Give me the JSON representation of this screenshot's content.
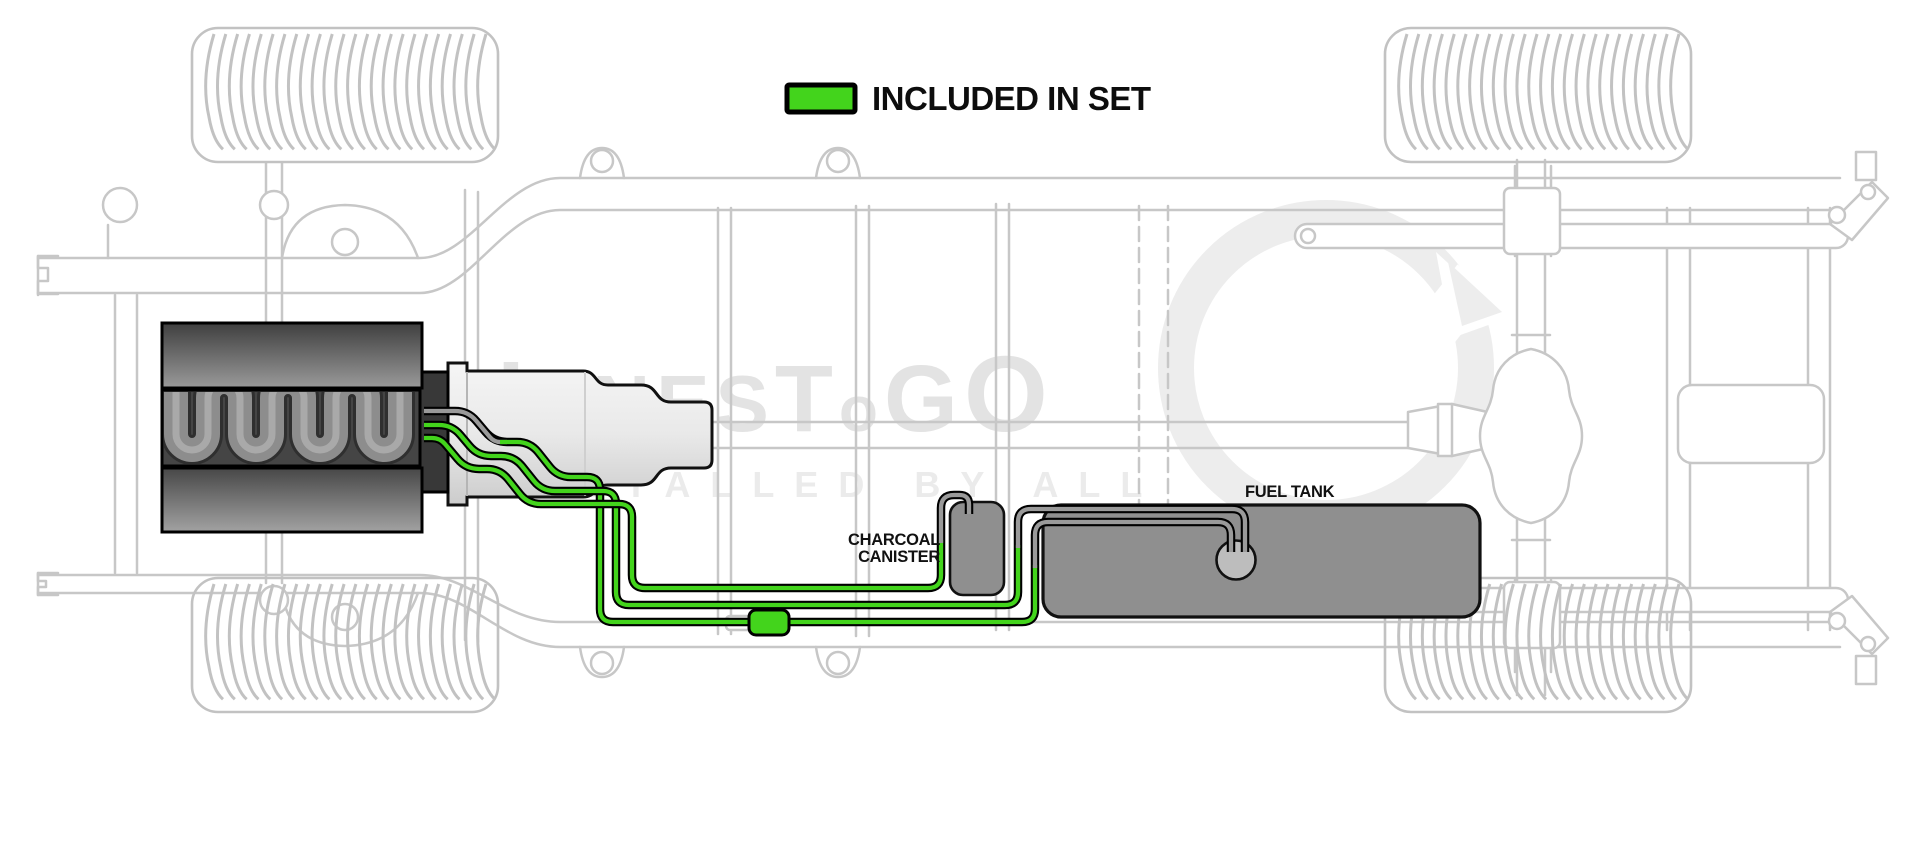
{
  "legend": {
    "label": "INCLUDED IN SET",
    "swatch_color": "#43d41c"
  },
  "labels": {
    "charcoal_canister_line1": "CHARCOAL",
    "charcoal_canister_line2": "CANISTER",
    "fuel_tank": "FUEL TANK"
  },
  "watermark": {
    "brand_parts": [
      "L",
      "INES",
      "T",
      "o",
      "G",
      "O"
    ],
    "tagline": "INSTALLED BY ALL"
  },
  "diagram": {
    "included_line_color": "#43d41c",
    "excluded_line_color": "#9a9a9a",
    "line_outline_color": "#000000",
    "frame_color": "#c7c7c7",
    "tank_fill": "#8f8f8f",
    "canister_fill": "#8f8f8f"
  }
}
